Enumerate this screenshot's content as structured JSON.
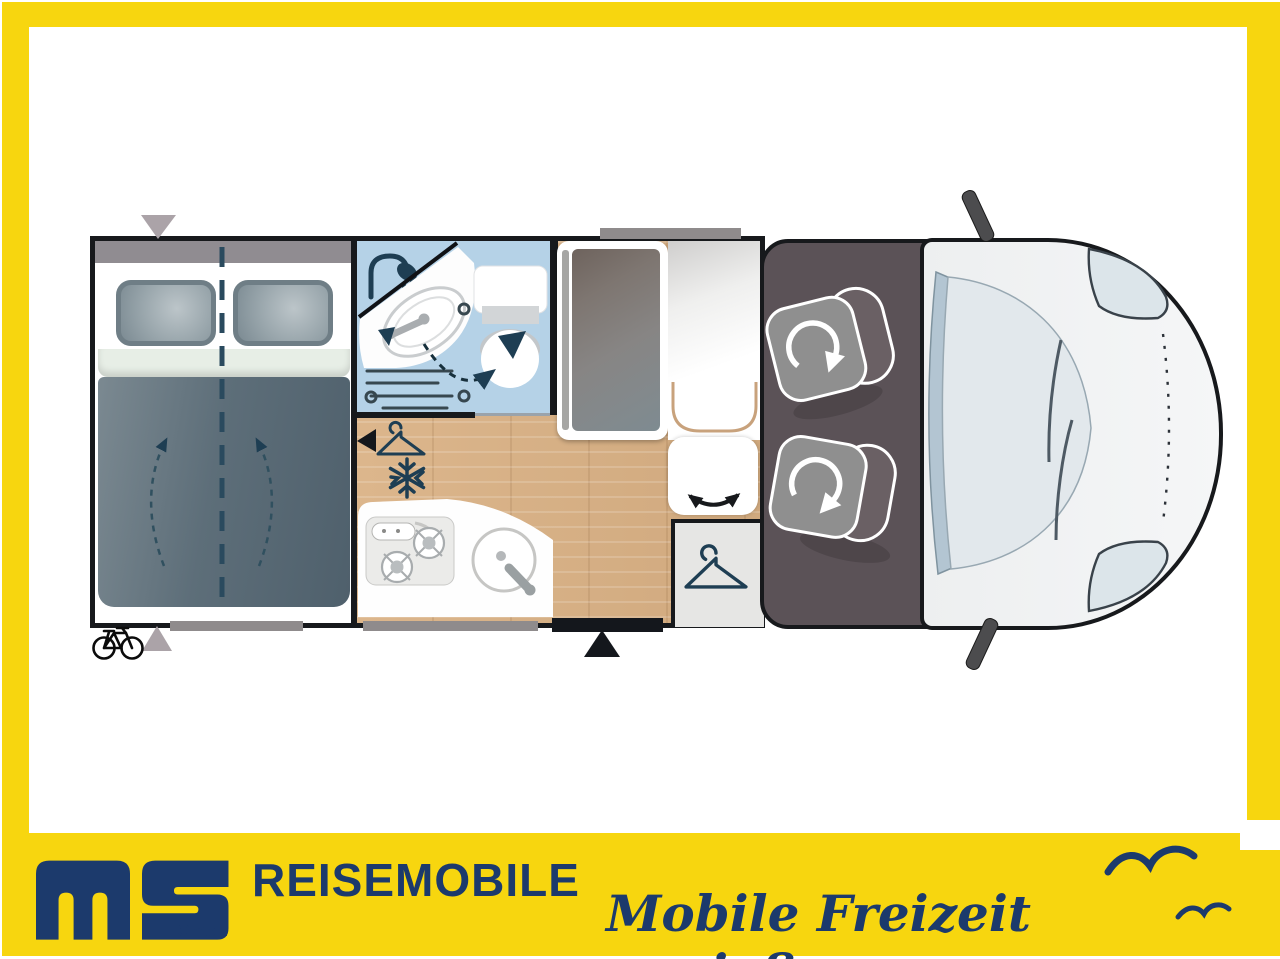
{
  "branding": {
    "logo_letters": "ms",
    "gmbh": "GmbH",
    "wordmark": "REISEMOBILE",
    "tagline": "Mobile Freizeit genießen.",
    "colors": {
      "frame_yellow": "#f7d60f",
      "brand_navy": "#1c3a6c"
    },
    "decor_icons": [
      "seagull-icon",
      "seagull-icon-small"
    ]
  },
  "floorplan": {
    "vehicle_type": "semi-integrated motorhome, top view",
    "zones": [
      "rear-double-bed",
      "bathroom",
      "kitchen",
      "fridge-cabinet",
      "bench-seat",
      "wardrobe",
      "driver-cab",
      "vehicle-front"
    ],
    "icons": {
      "snowflake_glyph": "❄",
      "shower": "shower-head-icon",
      "wardrobe_hanger": "clothes-hanger-icon",
      "floor_hanger": "clothes-hanger-icon",
      "bicycle": "bicycle-icon",
      "entry_door_marker": "black-triangle-up",
      "rear_marker_top": "gray-triangle-down",
      "rear_marker_bottom": "gray-triangle-up",
      "seat_rotation": "rotation-arrow-icon",
      "bench_swivel": "double-curved-arrow-icon",
      "bed_extension": "dashed-up-arrows",
      "sink_swivel": "dashed-curved-arrow"
    },
    "colors": {
      "bathroom_blue": "#b5d2e7",
      "wood_floor": "#d7b086",
      "cab_gray": "#5b5257",
      "bed_slate": "#5d6e79",
      "body_white": "#f1f2f3",
      "icon_navy": "#1e3e53"
    }
  }
}
